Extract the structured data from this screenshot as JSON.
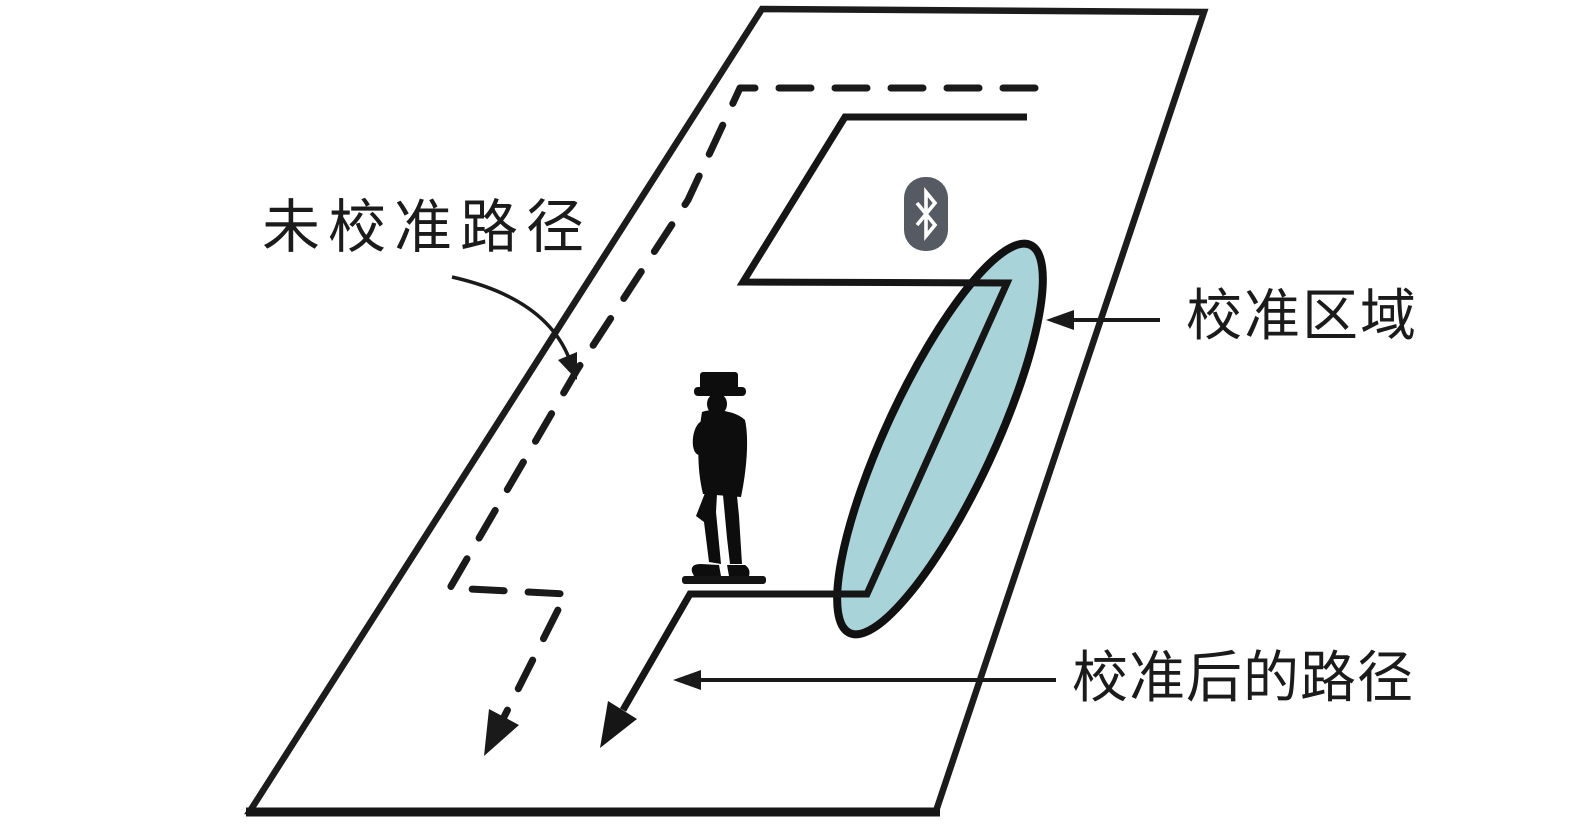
{
  "labels": {
    "uncalibrated_path": "未校准路径",
    "calibration_region": "校准区域",
    "calibrated_path_after": "校准后的路径"
  },
  "icons": {
    "bluetooth": "bluetooth-icon"
  },
  "colors": {
    "background": "#ffffff",
    "ink": "#1a1a1a",
    "calibration_region_fill": "#a8d3d9",
    "bluetooth_badge": "#565b63",
    "bluetooth_glyph": "#ffffff",
    "person_silhouette": "#0d0d0d"
  }
}
